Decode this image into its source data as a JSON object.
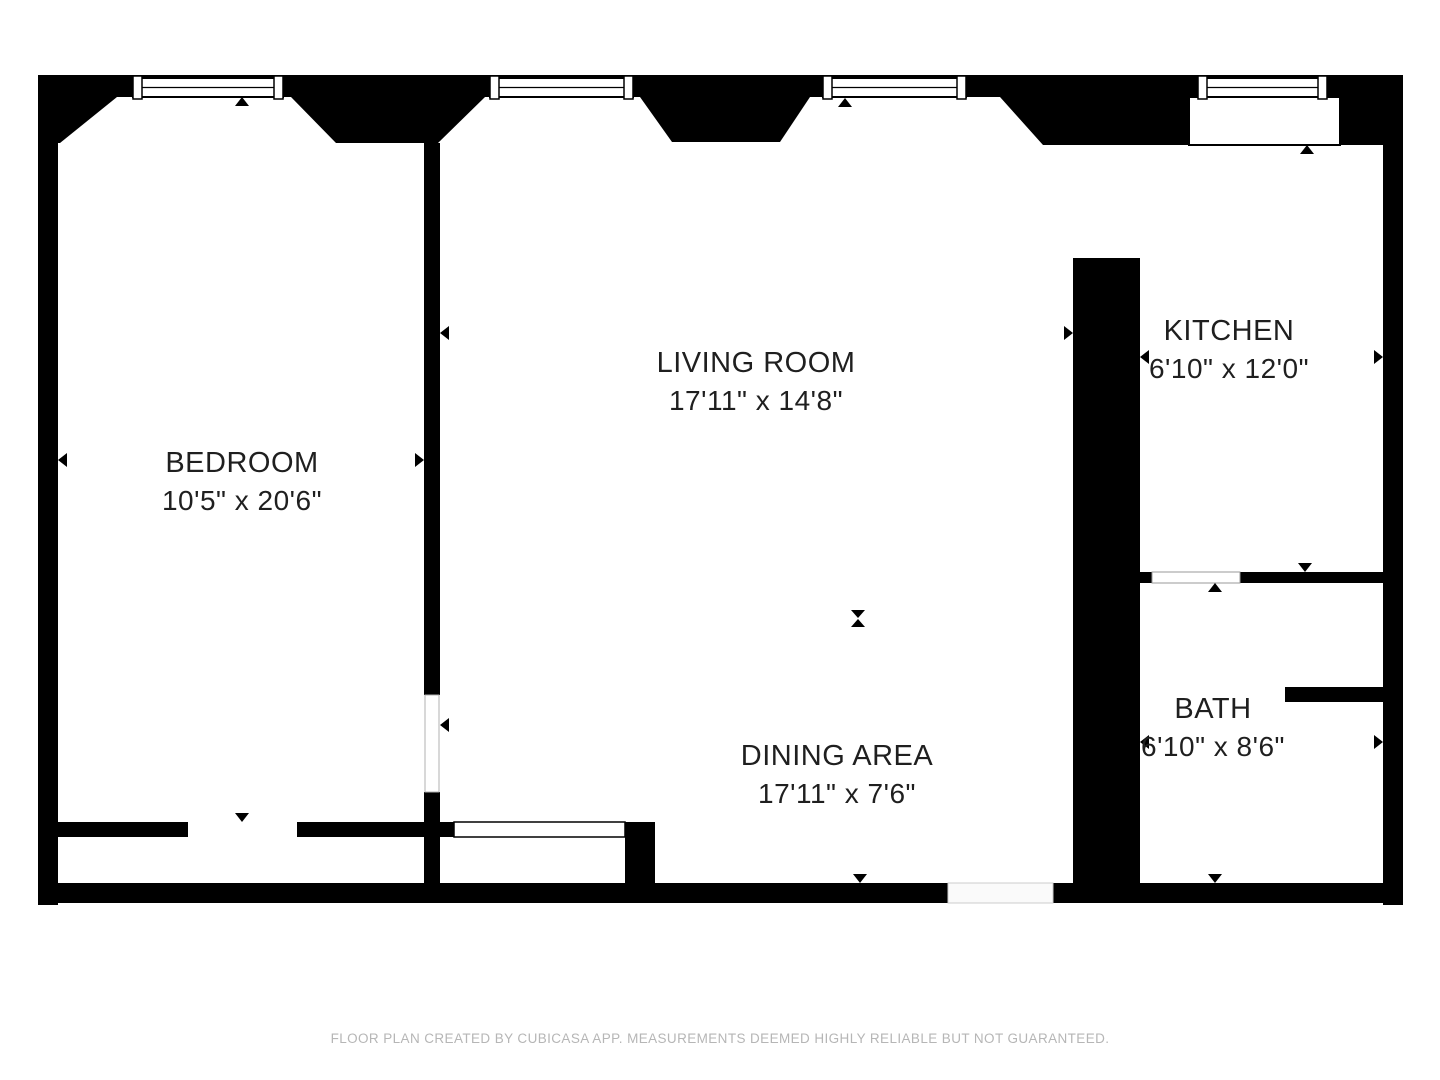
{
  "plan": {
    "type": "floor-plan",
    "colors": {
      "wall": "#000000",
      "floor": "#ffffff",
      "room_text": "#1f1f1f",
      "footer_text": "#b6b6b6",
      "door_gap": "#fafafa"
    },
    "rooms": [
      {
        "id": "bedroom",
        "label": "BEDROOM",
        "dimensions": "10'5\" x 20'6\""
      },
      {
        "id": "living-room",
        "label": "LIVING ROOM",
        "dimensions": "17'11\" x 14'8\""
      },
      {
        "id": "kitchen",
        "label": "KITCHEN",
        "dimensions": "6'10\" x 12'0\""
      },
      {
        "id": "bath",
        "label": "BATH",
        "dimensions": "6'10\" x 8'6\""
      },
      {
        "id": "dining-area",
        "label": "DINING AREA",
        "dimensions": "17'11\" x 7'6\""
      }
    ],
    "icons": {
      "window": "double-line window with end jambs",
      "dimension_arrow": "small black triangle pointing at wall",
      "dimension_split_marker": "hourglass triangle pair"
    },
    "footer": {
      "disclaimer": "FLOOR PLAN CREATED BY CUBICASA APP. MEASUREMENTS DEEMED HIGHLY RELIABLE BUT NOT GUARANTEED."
    }
  }
}
